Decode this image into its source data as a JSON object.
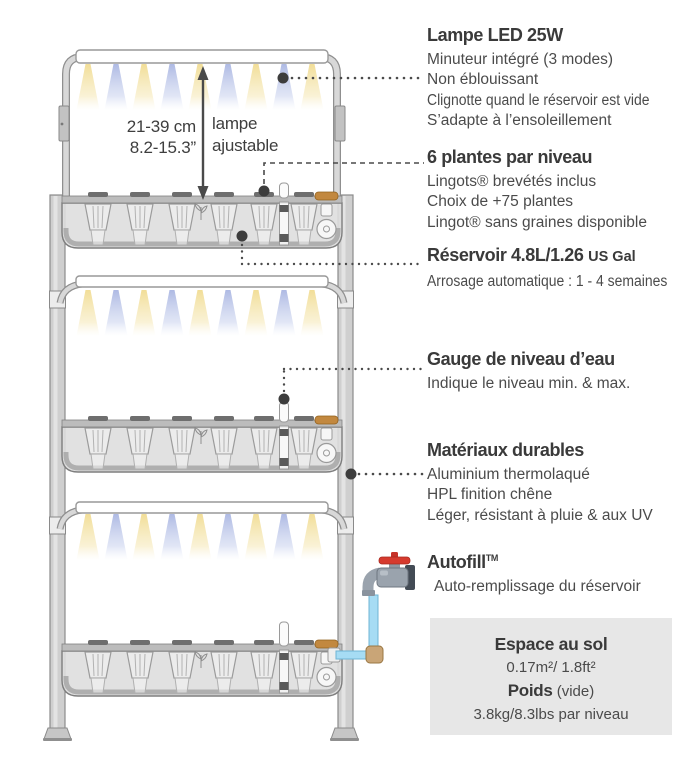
{
  "diagram": {
    "lamp_height_metric": "21-39 cm",
    "lamp_height_imperial": "8.2-15.3”",
    "lamp_adjustable_line1": "lampe",
    "lamp_adjustable_line2": "ajustable",
    "colors": {
      "light_warm": "#f1dc92",
      "light_cool": "#aab6e2",
      "pipe_blue": "#a6dcf4",
      "faucet_handle_red": "#d63a2e",
      "inlet_cap_orange": "#c2883f",
      "spec_box_bg": "#e7e7e7"
    }
  },
  "features": [
    {
      "title": "Lampe LED 25W",
      "lines": [
        "Minuteur intégré (3 modes)",
        "Non éblouissant",
        "Clignotte quand le réservoir est vide",
        "S’adapte à l’ensoleillement"
      ]
    },
    {
      "title": "6 plantes par niveau",
      "lines": [
        "Lingots® brevétés inclus",
        "Choix de +75 plantes",
        "Lingot® sans graines disponible"
      ]
    },
    {
      "title": "Réservoir 4.8L/1.26",
      "title_suffix": "US Gal",
      "lines": [
        "Arrosage automatique : 1 - 4 semaines"
      ]
    },
    {
      "title": "Gauge de niveau d’eau",
      "lines": [
        "Indique le niveau min. & max."
      ]
    },
    {
      "title": "Matériaux durables",
      "lines": [
        "Aluminium thermolaqué",
        "HPL finition chêne",
        "Léger, résistant à pluie & aux UV"
      ]
    },
    {
      "title": "Autofill",
      "trademark": "TM",
      "lines": [
        "Auto-remplissage du réservoir"
      ]
    }
  ],
  "spec_box": {
    "title": "Espace au sol",
    "area": "0.17m²/ 1.8ft²",
    "weight_label": "Poids",
    "weight_note": "(vide)",
    "weight_value": "3.8kg/8.3lbs par niveau"
  }
}
